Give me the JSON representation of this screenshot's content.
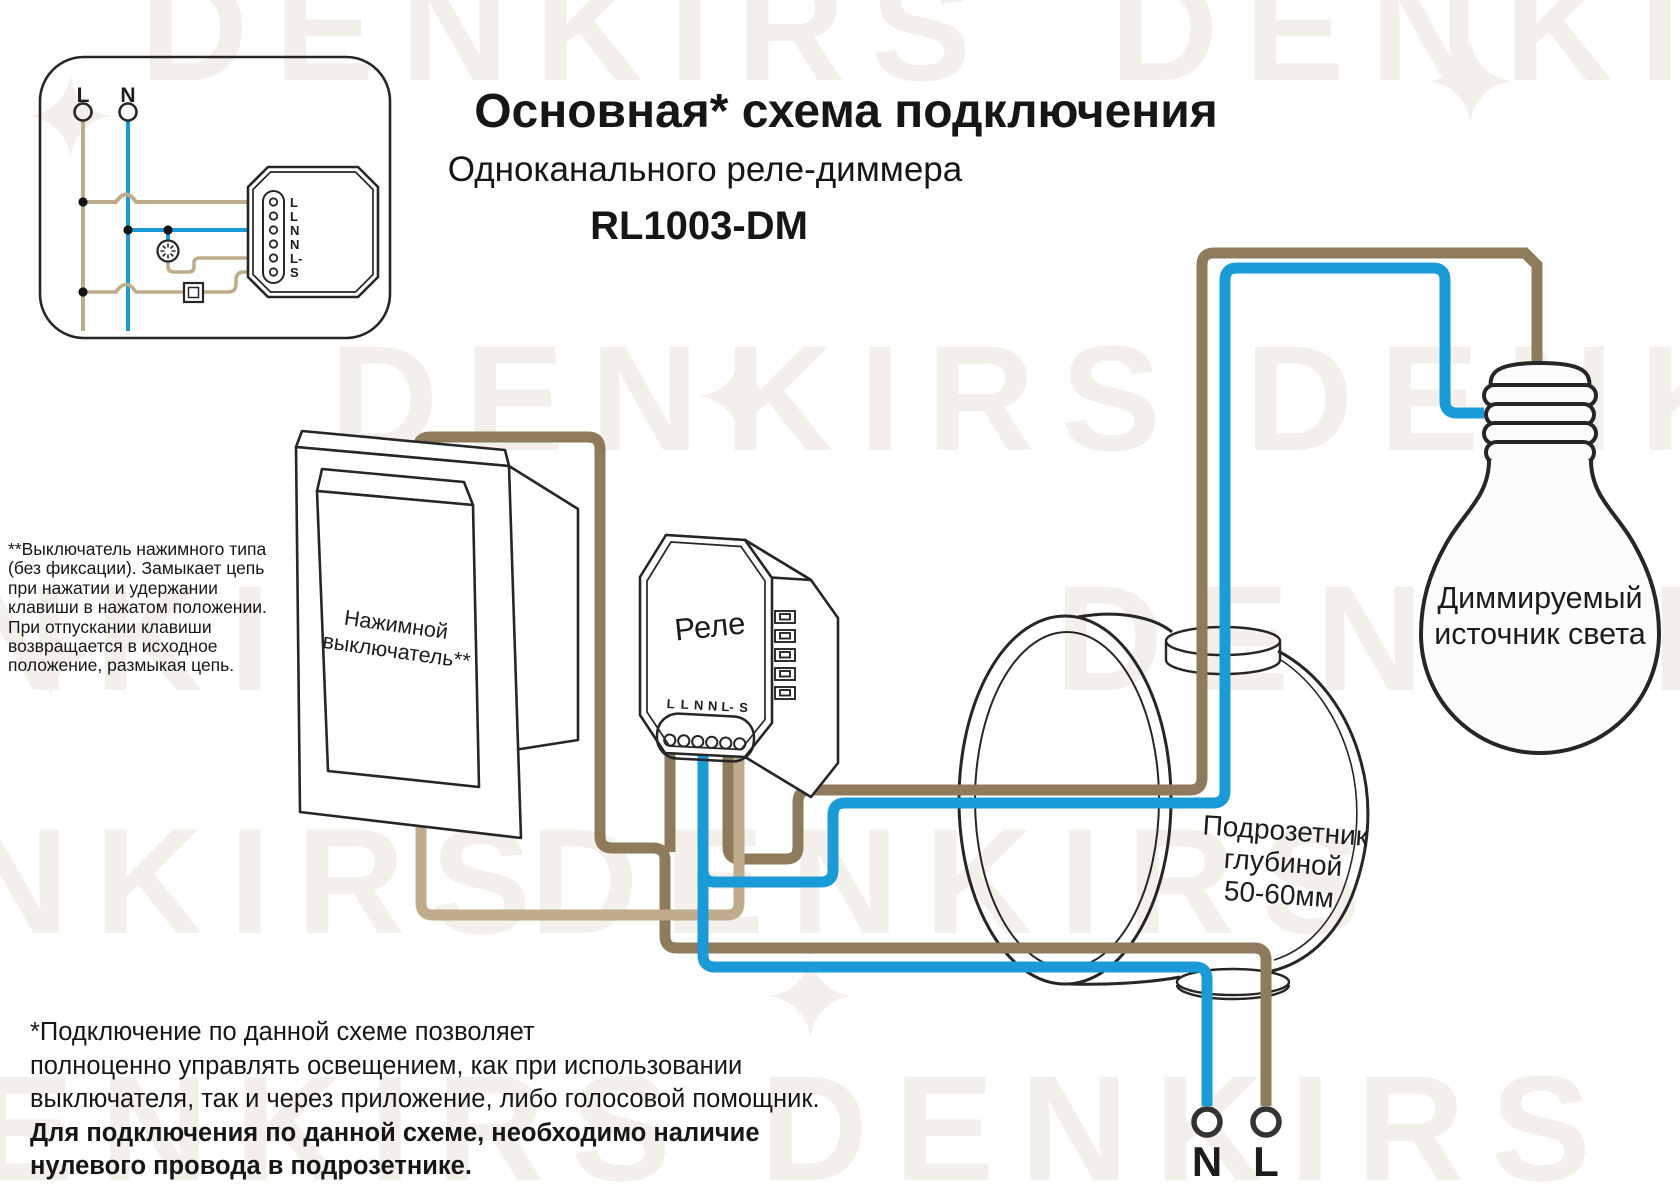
{
  "title": {
    "line1": "Основная* схема подключения",
    "line2": "Одноканального реле-диммера",
    "line3": "RL1003-DM"
  },
  "footnote": {
    "l1": "**Выключатель нажимного типа",
    "l2": "(без фиксации). Замыкает цепь",
    "l3": "при нажатии и удержании",
    "l4": "клавиши в нажатом положении.",
    "l5": "При отпускании клавиши",
    "l6": "возвращается в исходное",
    "l7": "положение, размыкая цепь."
  },
  "note": {
    "l1": "*Подключение по данной схеме позволяет",
    "l2": "полноценно управлять освещением, как при использовании",
    "l3": "выключателя, так и через приложение, либо голосовой помощник.",
    "l4": "Для подключения по данной схеме, необходимо наличие",
    "l5": "нулевого провода в подрозетнике."
  },
  "inset": {
    "live_label": "L",
    "neutral_label": "N",
    "terminals": [
      "L",
      "L",
      "N",
      "N",
      "L-",
      "S"
    ]
  },
  "relay": {
    "label": "Реле",
    "terminals": [
      "L",
      "L",
      "N",
      "N",
      "L-",
      "S"
    ]
  },
  "switch_device": {
    "label_line1": "Нажимной",
    "label_line2": "выключатель**"
  },
  "socket_box": {
    "label_line1": "Подрозетник",
    "label_line2": "глубиной",
    "label_line3": "50-60мм"
  },
  "bulb": {
    "label_line1": "Диммируемый",
    "label_line2": "источник света"
  },
  "mains": {
    "neutral": "N",
    "live": "L"
  },
  "watermark": {
    "text": "DENKIRS",
    "star": "✦"
  },
  "colors": {
    "wire_live_dark": "#8d7b5c",
    "wire_live_light": "#bfac8c",
    "wire_neutral": "#1b9ad8",
    "ink": "#262626"
  }
}
